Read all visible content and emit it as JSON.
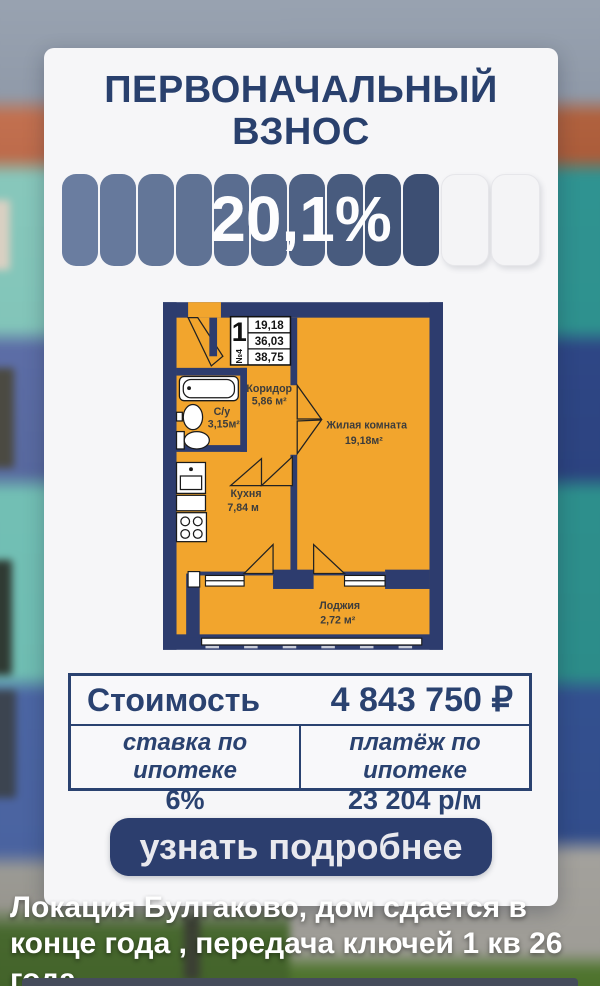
{
  "header": {
    "title_line1": "ПЕРВОНАЧАЛЬНЫЙ",
    "title_line2": "ВЗНОС"
  },
  "badge": {
    "value": "20,1%",
    "filled_segments": 10,
    "empty_segments": 2
  },
  "floorplan": {
    "table": {
      "rooms_count": "1",
      "unit_number": "№4",
      "living_area": "19,18",
      "area_no_loggia": "36,03",
      "total_area": "38,75"
    },
    "rooms": [
      {
        "name": "Коридор",
        "area": "5,86 м²"
      },
      {
        "name": "С/у",
        "area": "3,15м²"
      },
      {
        "name": "Жилая комната",
        "area": "19,18м²"
      },
      {
        "name": "Кухня",
        "area": "7,84 м"
      },
      {
        "name": "Лоджия",
        "area": "2,72 м²"
      }
    ]
  },
  "pricing": {
    "cost_label": "Стоимость",
    "cost_value": "4 843 750 ₽",
    "rate_label": "ставка по ипотеке",
    "rate_value": "6%",
    "payment_label": "платёж по ипотеке",
    "payment_value": "23 204 р/м"
  },
  "cta": {
    "label": "узнать подробнее"
  },
  "caption": "Локация Булгаково, дом сдается в конце года , передача ключей 1 кв 26 года",
  "colors": {
    "accent_navy": "#2a4270",
    "plan_orange": "#f2a52d",
    "plan_wall": "#2d3c6e",
    "button": "#2c3e6e",
    "card": "#f6f6f8",
    "badge_start": "#6a7da0",
    "badge_end": "#3d4f73"
  }
}
